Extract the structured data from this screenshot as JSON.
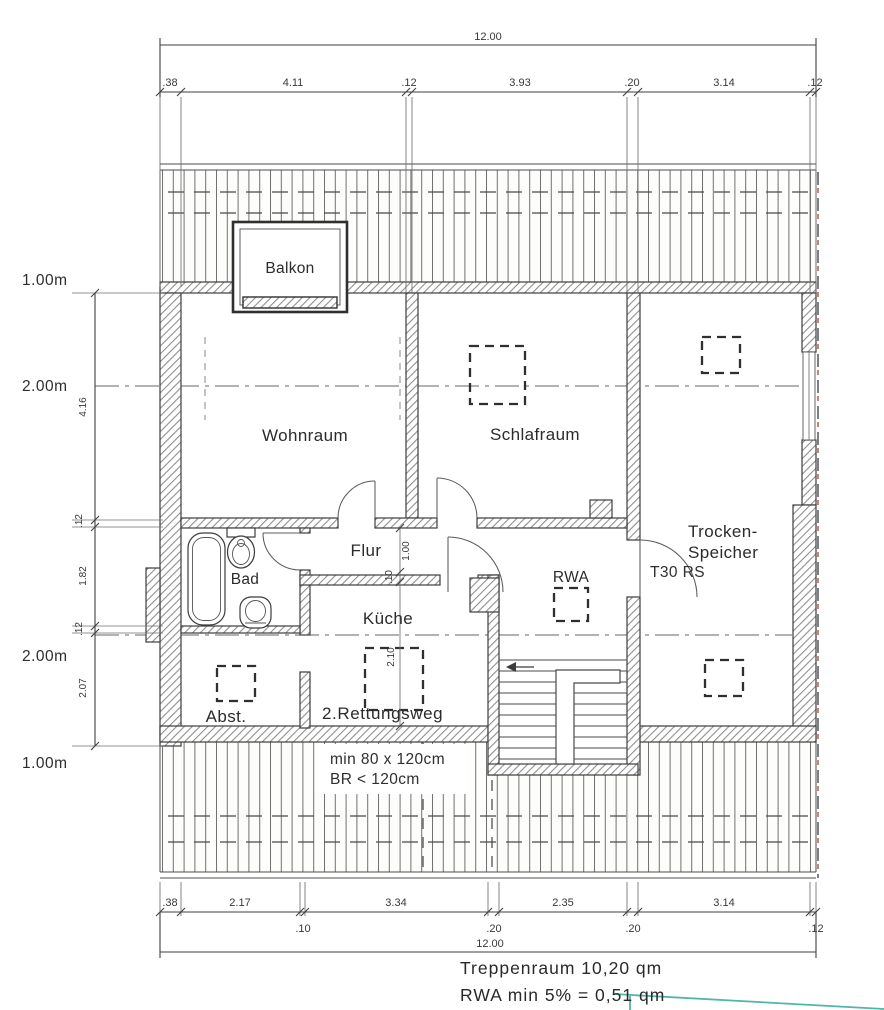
{
  "drawing": {
    "type": "architectural-floor-plan",
    "rooms": {
      "balkon": "Balkon",
      "wohnraum": "Wohnraum",
      "schlafraum": "Schlafraum",
      "trocken_line1": "Trocken-",
      "trocken_line2": "Speicher",
      "bad": "Bad",
      "flur": "Flur",
      "kueche": "Küche",
      "abst": "Abst.",
      "rwa": "RWA"
    },
    "annotations": {
      "t30": "T30 RS",
      "rettungsweg": "2.Rettungsweg",
      "min_size": "min 80 x 120cm",
      "br": "BR < 120cm"
    },
    "footer": {
      "line1": "Treppenraum 10,20 qm",
      "line2": "RWA min 5% = 0,51 qm"
    },
    "dimensions": {
      "top": {
        "overall": "12.00",
        "segments": [
          ".38",
          "4.11",
          ".12",
          "3.93",
          ".20",
          "3.14",
          ".12"
        ]
      },
      "bottom": {
        "overall": "12.00",
        "row1": [
          ".38",
          "2.17",
          "3.34",
          "2.35",
          "3.14"
        ],
        "row2": [
          ".10",
          ".20",
          ".20",
          ".12"
        ]
      },
      "left": {
        "heights": [
          "1.00m",
          "2.00m",
          "2.00m",
          "1.00m"
        ],
        "segments": [
          "4.16",
          ".12",
          "1.82",
          ".12",
          "2.07"
        ]
      },
      "inner": [
        "1.00",
        ".10",
        "2.10"
      ]
    },
    "colors": {
      "line": "#3c3c3c",
      "hatch": "#8f8f8f",
      "red_dash": "#b0503a",
      "teal": "#50b6a6"
    }
  }
}
